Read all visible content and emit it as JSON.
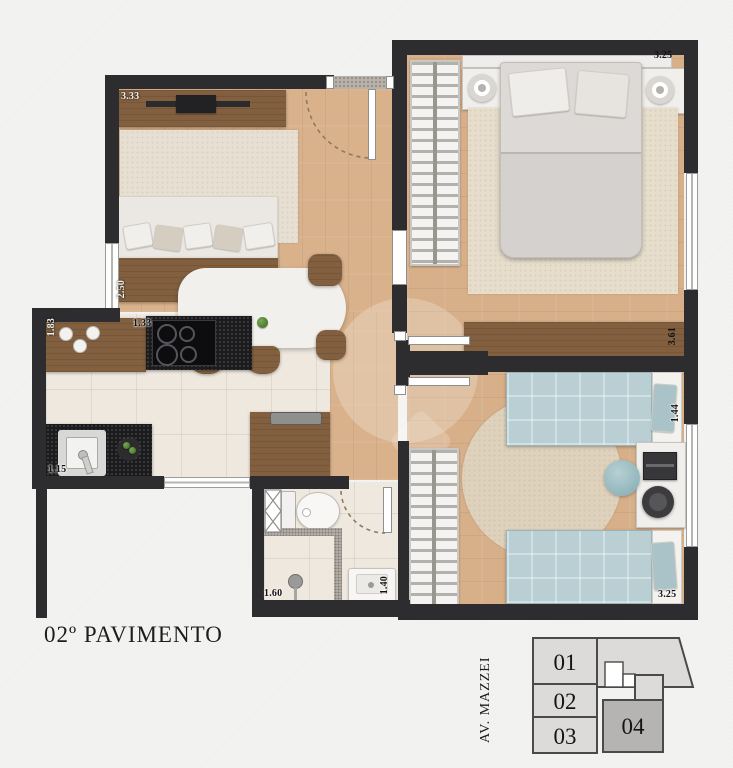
{
  "title": "02º PAVIMENTO",
  "dimensions": {
    "living_width": "3.33",
    "living_depth": "2.50",
    "kitchen_width": "1.83",
    "cooktop_width": "1.33",
    "kitchen_counter": "1.15",
    "bedroom1_width": "3.25",
    "bedroom1_depth": "3.61",
    "desk_width": "1.44",
    "bath_width": "1.60",
    "bath_depth": "1.40",
    "bedroom2_width": "3.25"
  },
  "keyplan": {
    "street": "AV. MAZZEI",
    "units": [
      {
        "label": "01"
      },
      {
        "label": "02"
      },
      {
        "label": "03"
      },
      {
        "label": "04"
      }
    ],
    "highlighted_unit": "04"
  }
}
